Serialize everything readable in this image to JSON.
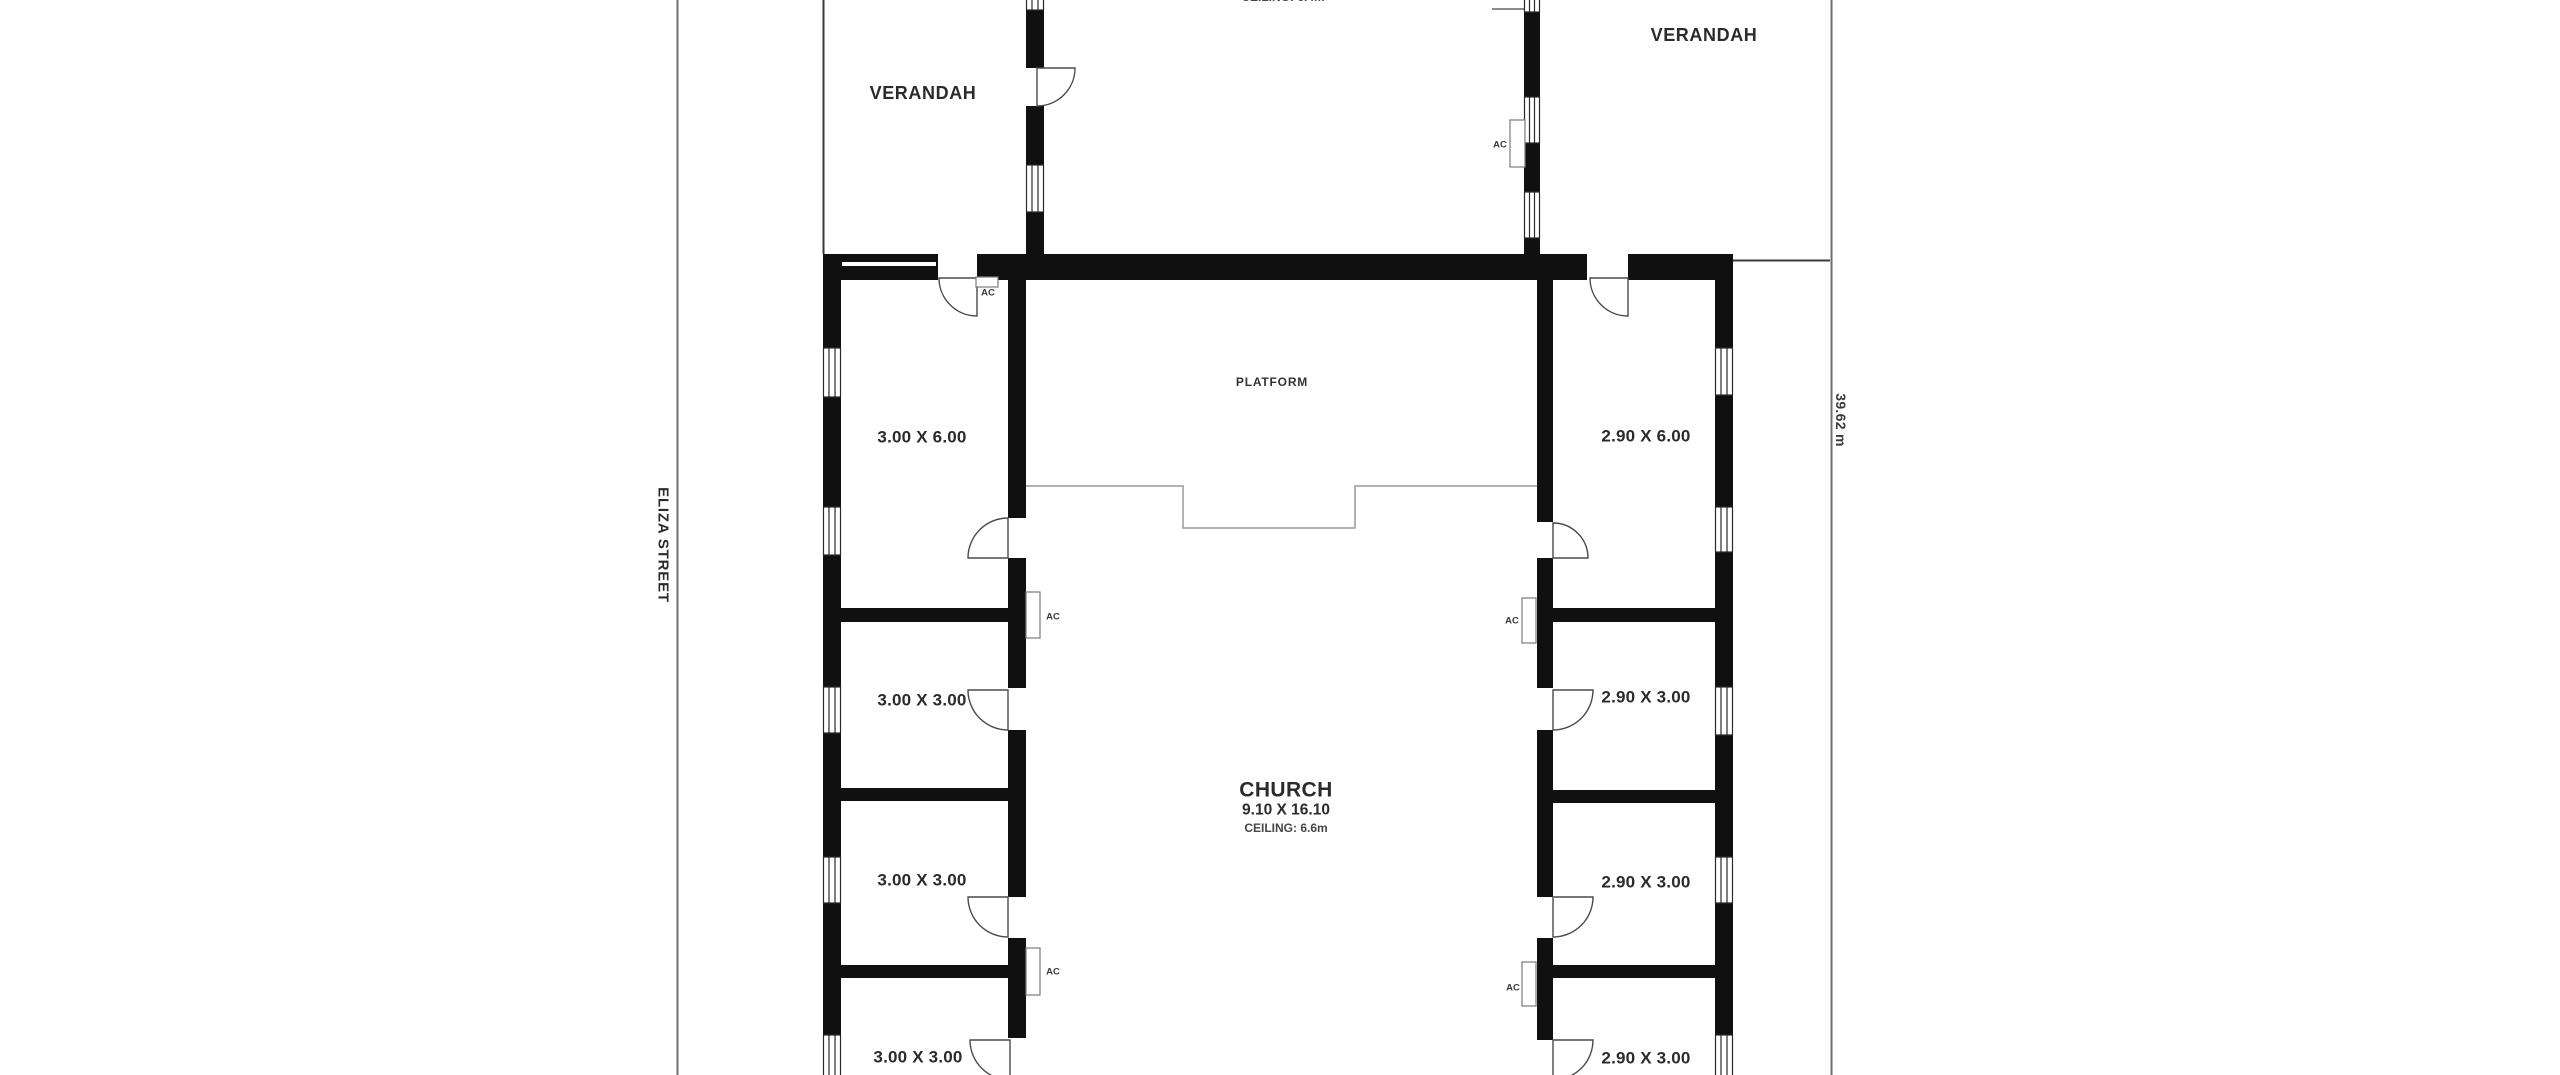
{
  "labels": {
    "street": "ELIZA STREET",
    "boundary_length": "39.62 m",
    "verandah_left": "VERANDAH",
    "verandah_right": "VERANDAH",
    "top_ceiling_partial": "CEILING: 6.4m",
    "platform": "PLATFORM",
    "ac": "AC"
  },
  "church": {
    "name": "CHURCH",
    "dimensions": "9.10 X 16.10",
    "ceiling": "CEILING: 6.6m"
  },
  "rooms_left": [
    {
      "label": "3.00 X 6.00"
    },
    {
      "label": "3.00 X 3.00"
    },
    {
      "label": "3.00 X 3.00"
    },
    {
      "label": "3.00 X 3.00"
    }
  ],
  "rooms_right": [
    {
      "label": "2.90 X 6.00"
    },
    {
      "label": "2.90 X 3.00"
    },
    {
      "label": "2.90 X 3.00"
    },
    {
      "label": "2.90 X 3.00"
    }
  ],
  "colors": {
    "wall": "#101010",
    "boundary_line": "#6f6f6f",
    "platform_line": "#9a9a9a",
    "door_line": "#4a4a4a",
    "text": "#2b2b2b",
    "background": "#ffffff"
  }
}
